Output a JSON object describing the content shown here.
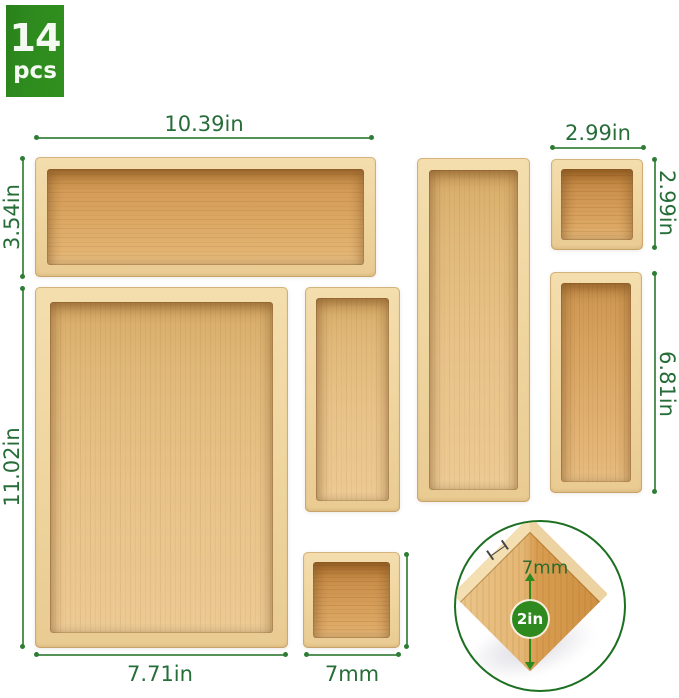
{
  "badge": {
    "count": "14",
    "unit": "pcs"
  },
  "annotations": {
    "top_tray_width": "10.39in",
    "top_tray_height": "3.54in",
    "large_tray_height": "11.02in",
    "large_tray_width": "7.71in",
    "small_square_tray_width": "7mm",
    "top_right_tray_width": "2.99in",
    "top_right_tray_height": "2.99in",
    "right_tray_height": "6.81in"
  },
  "inset": {
    "wall_thickness": "7mm",
    "tray_depth": "2in"
  },
  "colors": {
    "badge_green": "#2e8a1e",
    "label_green": "#266d38",
    "dimension_line_green": "#549257",
    "inset_ring_green": "#1d7021",
    "wood_frame_light": "#f2d9a6",
    "wood_interior_dark": "#c8914a",
    "wood_interior_light": "#e7c187",
    "background": "#ffffff"
  }
}
